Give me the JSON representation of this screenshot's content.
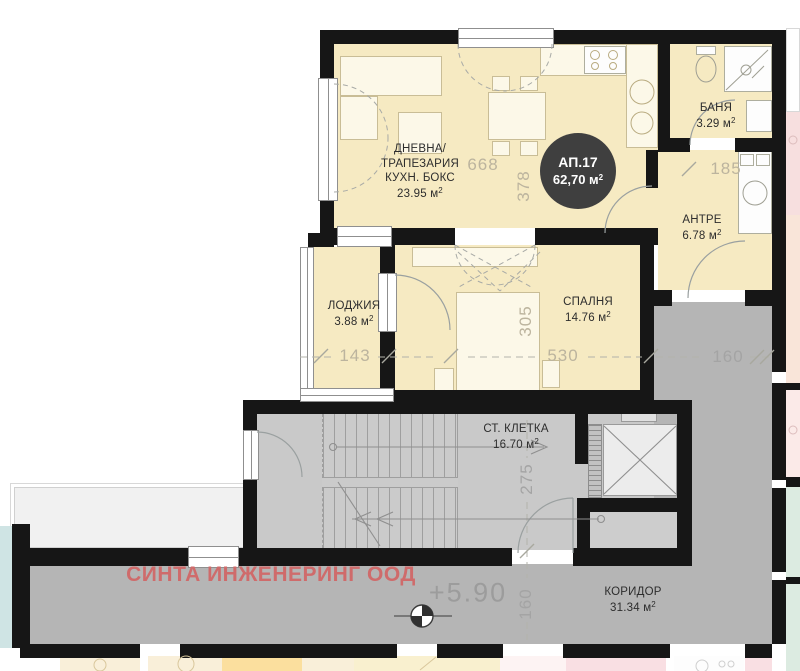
{
  "watermark": {
    "text": "СИНТА ИНЖЕНЕРИНГ ООД"
  },
  "badge": {
    "unit": "АП.17",
    "area": "62,70 м",
    "sup": "2"
  },
  "level": {
    "value": "+5.90"
  },
  "rooms": {
    "living": {
      "lines": [
        "ДНЕВНА/",
        "ТРАПЕЗАРИЯ",
        "КУХН. БОКС"
      ],
      "area": "23.95 м",
      "sup": "2"
    },
    "bath": {
      "name": "БАНЯ",
      "area": "3.29 м",
      "sup": "2"
    },
    "antre": {
      "name": "АНТРЕ",
      "area": "6.78 м",
      "sup": "2"
    },
    "loggia": {
      "name": "ЛОДЖИЯ",
      "area": "3.88 м",
      "sup": "2"
    },
    "bedroom": {
      "name": "СПАЛНЯ",
      "area": "14.76 м",
      "sup": "2"
    },
    "stairwell": {
      "name": "СТ. КЛЕТКА",
      "area": "16.70 м",
      "sup": "2"
    },
    "corridor": {
      "name": "КОРИДОР",
      "area": "31.34 м",
      "sup": "2"
    }
  },
  "dimensions": {
    "d668": "668",
    "d378": "378",
    "d185": "185",
    "d143": "143",
    "d530": "530",
    "d305": "305",
    "d275": "275",
    "d160v": "160",
    "d160h": "160"
  },
  "colors": {
    "wall": "#161616",
    "floor": "#f6eac2",
    "corr": "#b5b5b5",
    "stair": "#c9c9c9",
    "terrace": "#f1f1f1",
    "wm": "#cf6b6b",
    "badge": "#3f3f3f"
  }
}
